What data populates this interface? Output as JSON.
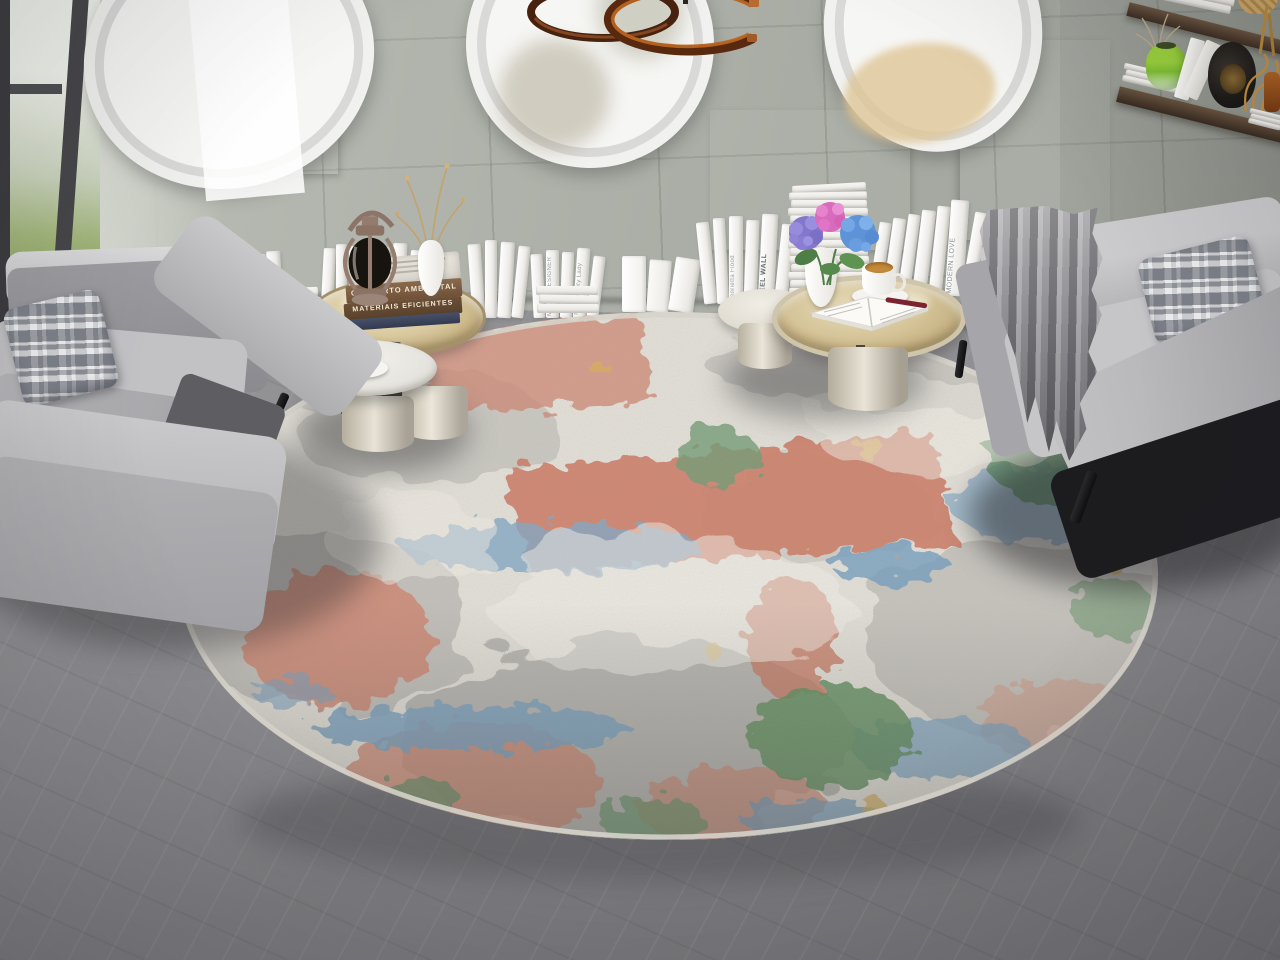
{
  "books": {
    "tray_stack_titles": [
      "CONFORTO AMBIENTAL",
      "MATERIAIS EFICIENTES"
    ],
    "spines": {
      "fatalism": "FATALISM of YOURSELF",
      "biological": "Biological Prado",
      "designer": "Modern DESIGNER",
      "beauty_lady": "Thin Beauty Lady",
      "henrietta": "Henrietta Flood",
      "steel_wall": "STEEL WALL",
      "modern_love": "MODERN LOVE"
    }
  },
  "palette": {
    "wall": "#b2b6ad",
    "floor": "#8a8a8e",
    "rug_base": "#e4e1d9",
    "rug_gray": "#a7a6a2",
    "rug_coral": "#cf8169",
    "rug_blue": "#7fa6c4",
    "rug_green": "#649165",
    "rug_yellow": "#d9ae55",
    "rug_edge": "#d6d3ca",
    "sofa_gray": "#b9b9bc",
    "blanket_gray": "#8f8f92",
    "tray_gold": "#c9b285",
    "table_cream": "#e7e3da",
    "shelf_wood": "#4a392d",
    "pendant_walnut": "#5a2d1a",
    "pendant_copper": "#b0622f",
    "lantern_bronze": "#a18a7d",
    "coffee": "#b5713d",
    "hydrangea_violet": "#8f7fd4",
    "hydrangea_pink": "#e07ec6",
    "hydrangea_blue": "#74a7e4",
    "leaf_green": "#4e7d46",
    "garden_green": "#8fae6a",
    "book_white": "#f4f3ef",
    "book_spine_brown": "#7a5a40"
  }
}
